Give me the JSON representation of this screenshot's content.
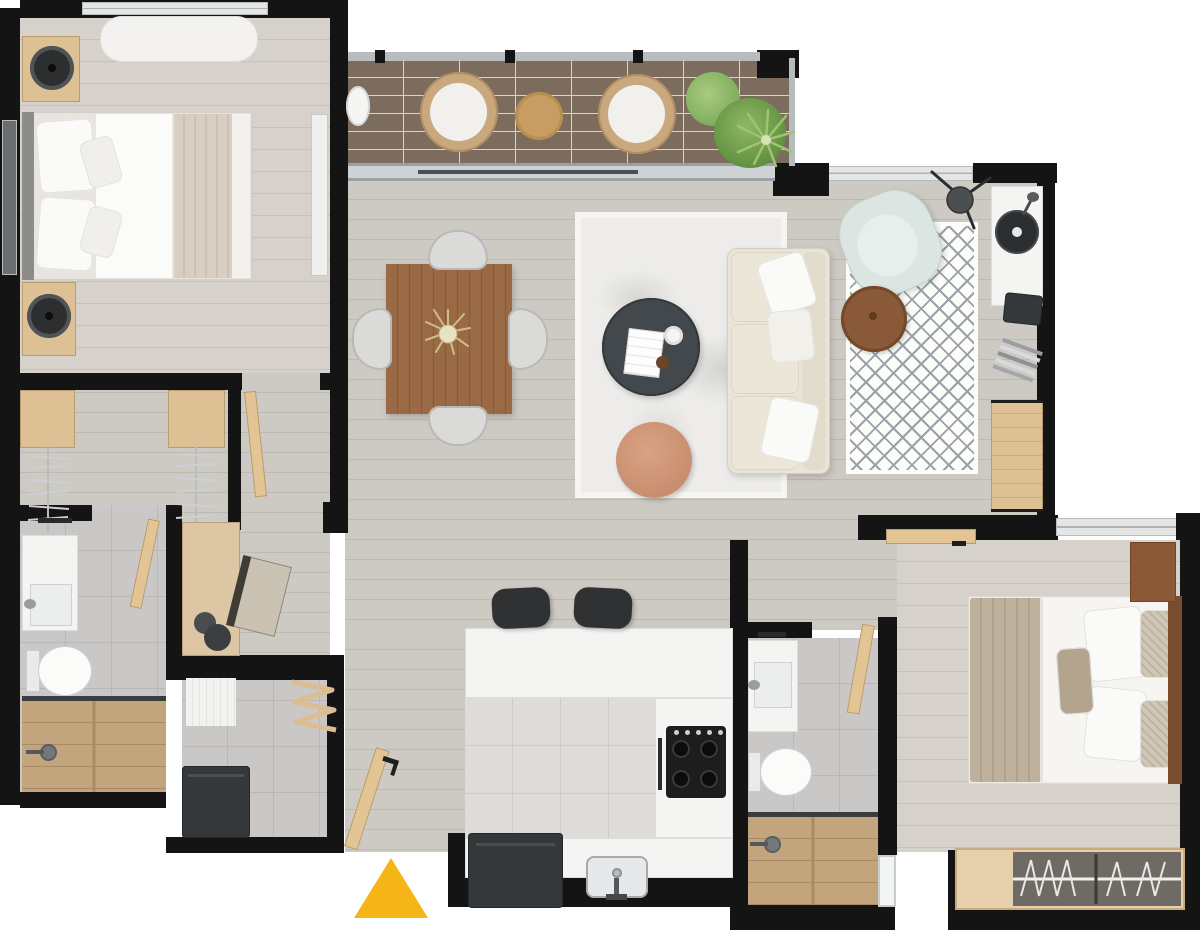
{
  "plan": {
    "title": "apartment-floor-plan-top-view",
    "entrance": {
      "marker_shape": "triangle",
      "marker_color": "#F6B517"
    },
    "rooms": [
      {
        "id": "bedroom-1",
        "furniture": [
          "double-bed",
          "bench",
          "nightstand",
          "speaker",
          "nightstand",
          "speaker",
          "mirror-wardrobe"
        ]
      },
      {
        "id": "balcony",
        "furniture": [
          "planter",
          "wicker-chair",
          "round-table",
          "wicker-chair",
          "plants"
        ]
      },
      {
        "id": "living-dining",
        "furniture": [
          "dining-table",
          "dining-chair",
          "dining-chair",
          "dining-chair",
          "dining-chair",
          "area-rug",
          "coffee-table",
          "pouf",
          "sofa",
          "armchair",
          "diamond-rug",
          "side-table",
          "floor-lamp",
          "record-player",
          "speaker",
          "magazines",
          "cabinet"
        ]
      },
      {
        "id": "hall-closet",
        "furniture": [
          "closet-shelf",
          "hanging-rail",
          "closet-shelf",
          "hanging-rail",
          "desk",
          "desk-lamp",
          "desk-chair"
        ]
      },
      {
        "id": "bathroom-1",
        "furniture": [
          "vanity-sink",
          "toilet",
          "walk-in-shower"
        ]
      },
      {
        "id": "laundry",
        "furniture": [
          "mat",
          "drying-rack",
          "washing-machine"
        ]
      },
      {
        "id": "kitchen",
        "furniture": [
          "island-counter",
          "bar-stool",
          "bar-stool",
          "cooktop",
          "oven",
          "sink",
          "refrigerator"
        ]
      },
      {
        "id": "bathroom-2",
        "furniture": [
          "vanity-sink",
          "toilet",
          "walk-in-shower"
        ]
      },
      {
        "id": "bedroom-2",
        "furniture": [
          "double-bed",
          "nightstand",
          "wardrobe",
          "door"
        ]
      }
    ]
  },
  "palette": {
    "wall": "#141414",
    "floor-wood": "#cdc9c3",
    "floor-wood-warm": "#d6d2cb",
    "balcony-tile": "#7b6c5d",
    "tile-gray": "#c9c8c6",
    "tile-light": "#dedcd9",
    "shower-wood": "#c2a47d",
    "rug-light": "#edecea",
    "rug-line": "#9aa1a7",
    "sofa": "#eae4d6",
    "armchair": "#dbe5e2",
    "table-dark": "#43484c",
    "pouf": "#c98e70",
    "dining-wood": "#9a6a47",
    "side-table": "#8a5939",
    "cabinet-wood": "#ddc094",
    "door-wood": "#e2c495",
    "appliance": "#35383a",
    "marker": "#F6B517",
    "plant": "#6e9a4b"
  }
}
